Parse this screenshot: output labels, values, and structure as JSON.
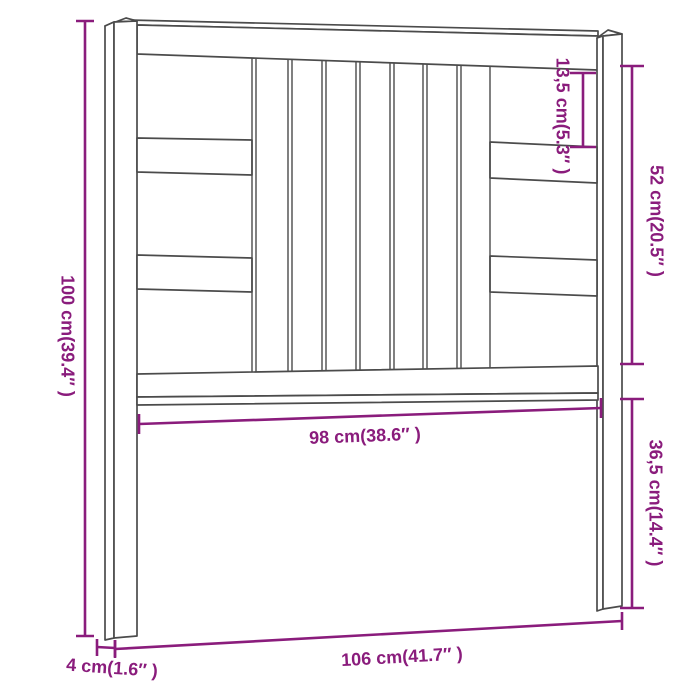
{
  "diagram": {
    "subject": "wooden slatted bed headboard dimension drawing",
    "background_color": "#ffffff",
    "drawing_line_color": "#4b4b4b",
    "dimension_color": "#8a1c7c"
  },
  "dimensions": {
    "total_height": "100 cm(39.4″ )",
    "top_opening_height": "13,5 cm(5.3″ )",
    "upper_section_height": "52 cm(20.5″ )",
    "leg_section_height": "36,5 cm(14.4″ )",
    "inner_width": "98 cm(38.6″ )",
    "total_width": "106 cm(41.7″ )",
    "post_depth": "4 cm(1.6″ )"
  }
}
